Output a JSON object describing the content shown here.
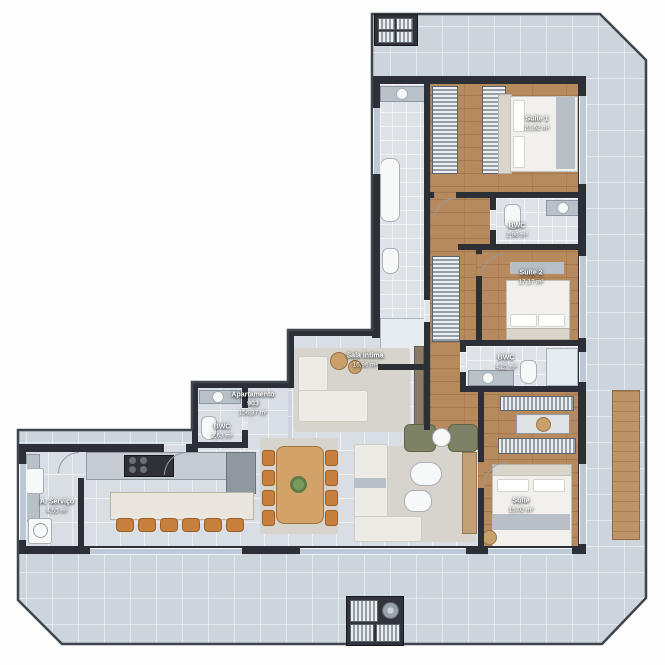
{
  "apartment": {
    "label": "Apartamento",
    "number": "903",
    "area": "156,37 m²"
  },
  "rooms": [
    {
      "name": "Suíte 1",
      "area": "21,62 m²"
    },
    {
      "name": "BWC",
      "area": "2,96 m²"
    },
    {
      "name": "Suíte 2",
      "area": "17,17 m²"
    },
    {
      "name": "BWC",
      "area": "4,25 m²"
    },
    {
      "name": "Sala Íntima",
      "area": "16,96 m²"
    },
    {
      "name": "BWC",
      "area": "2,63 m²"
    },
    {
      "name": "A. Serviço",
      "area": "4,55 m²"
    },
    {
      "name": "Suíte",
      "area": "15,02 m²"
    }
  ],
  "icons": {
    "fan": "exhaust-fan-icon",
    "condenser_top": "ac-condenser-unit",
    "condenser_bottom": "ac-condenser-units"
  },
  "colors": {
    "wall": "#2c3036",
    "terrace_tile": "#cdd5dc",
    "interior_tile": "#d8dee4",
    "wood_floor": "#b78a5e",
    "glass": "#bdc9d4",
    "furniture_wood": "#c8803e",
    "armchair_green": "#7d8264"
  }
}
